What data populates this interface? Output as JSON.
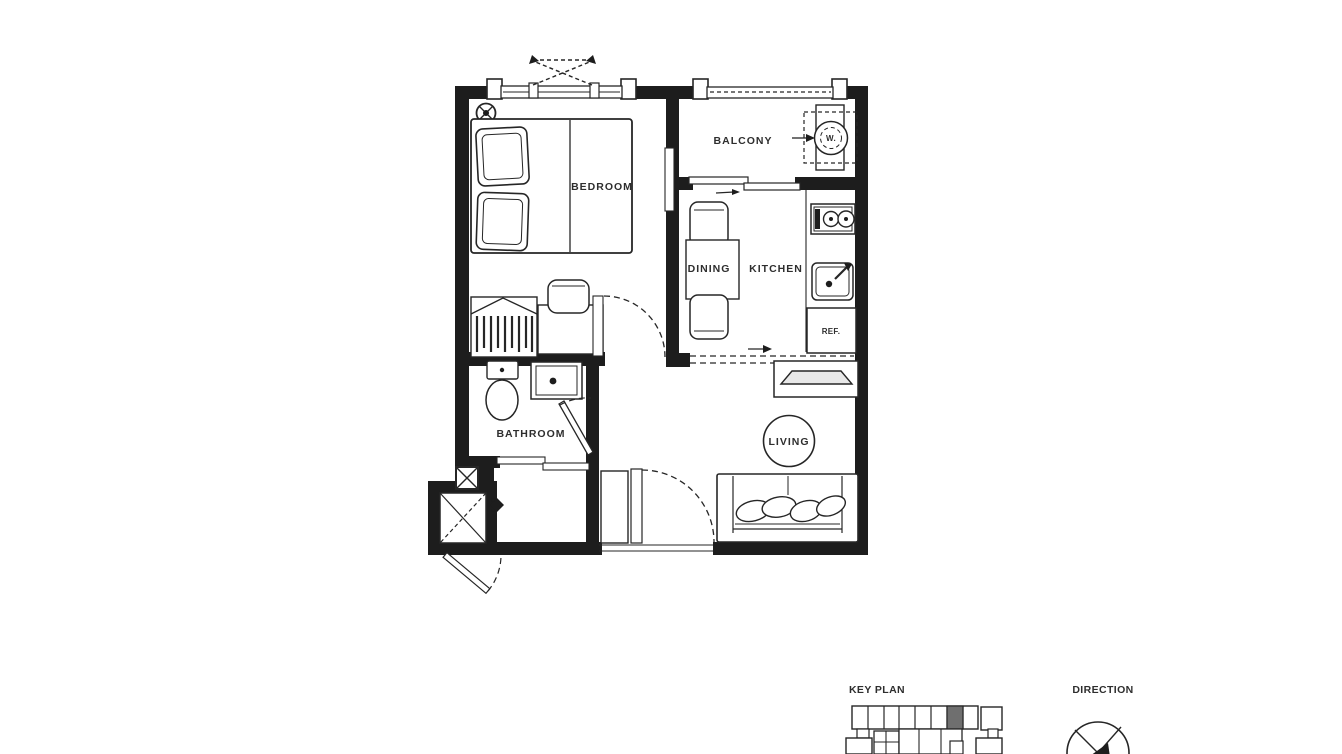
{
  "floor_plan": {
    "rooms": {
      "bedroom": "BEDROOM",
      "balcony": "BALCONY",
      "dining": "DINING",
      "kitchen": "KITCHEN",
      "bathroom": "BATHROOM",
      "living": "LIVING"
    },
    "appliances": {
      "washer": "W.",
      "refrigerator": "REF."
    }
  },
  "legend": {
    "key_plan": "KEY PLAN",
    "direction": "DIRECTION"
  },
  "colors": {
    "wall": "#1d1d1d",
    "line": "#262626",
    "label": "#2e2e2e",
    "keyplan_highlight": "#6f6f6f",
    "background": "#ffffff"
  },
  "icons": [
    "bed-icon",
    "pillow-icon",
    "sprinkler-icon",
    "window-swing-icon",
    "balcony-railing-icon",
    "washer-icon",
    "stove-icon",
    "kitchen-sink-icon",
    "refrigerator-icon",
    "dining-table-icon",
    "dining-chair-icon",
    "wardrobe-icon",
    "desk-icon",
    "stool-icon",
    "toilet-icon",
    "bath-sink-icon",
    "sliding-door-icon",
    "door-swing-arc-icon",
    "shaft-x-icon",
    "tv-console-icon",
    "sofa-icon",
    "entry-cabinet-icon",
    "door-closer-icon",
    "key-plan-map",
    "compass-icon"
  ]
}
